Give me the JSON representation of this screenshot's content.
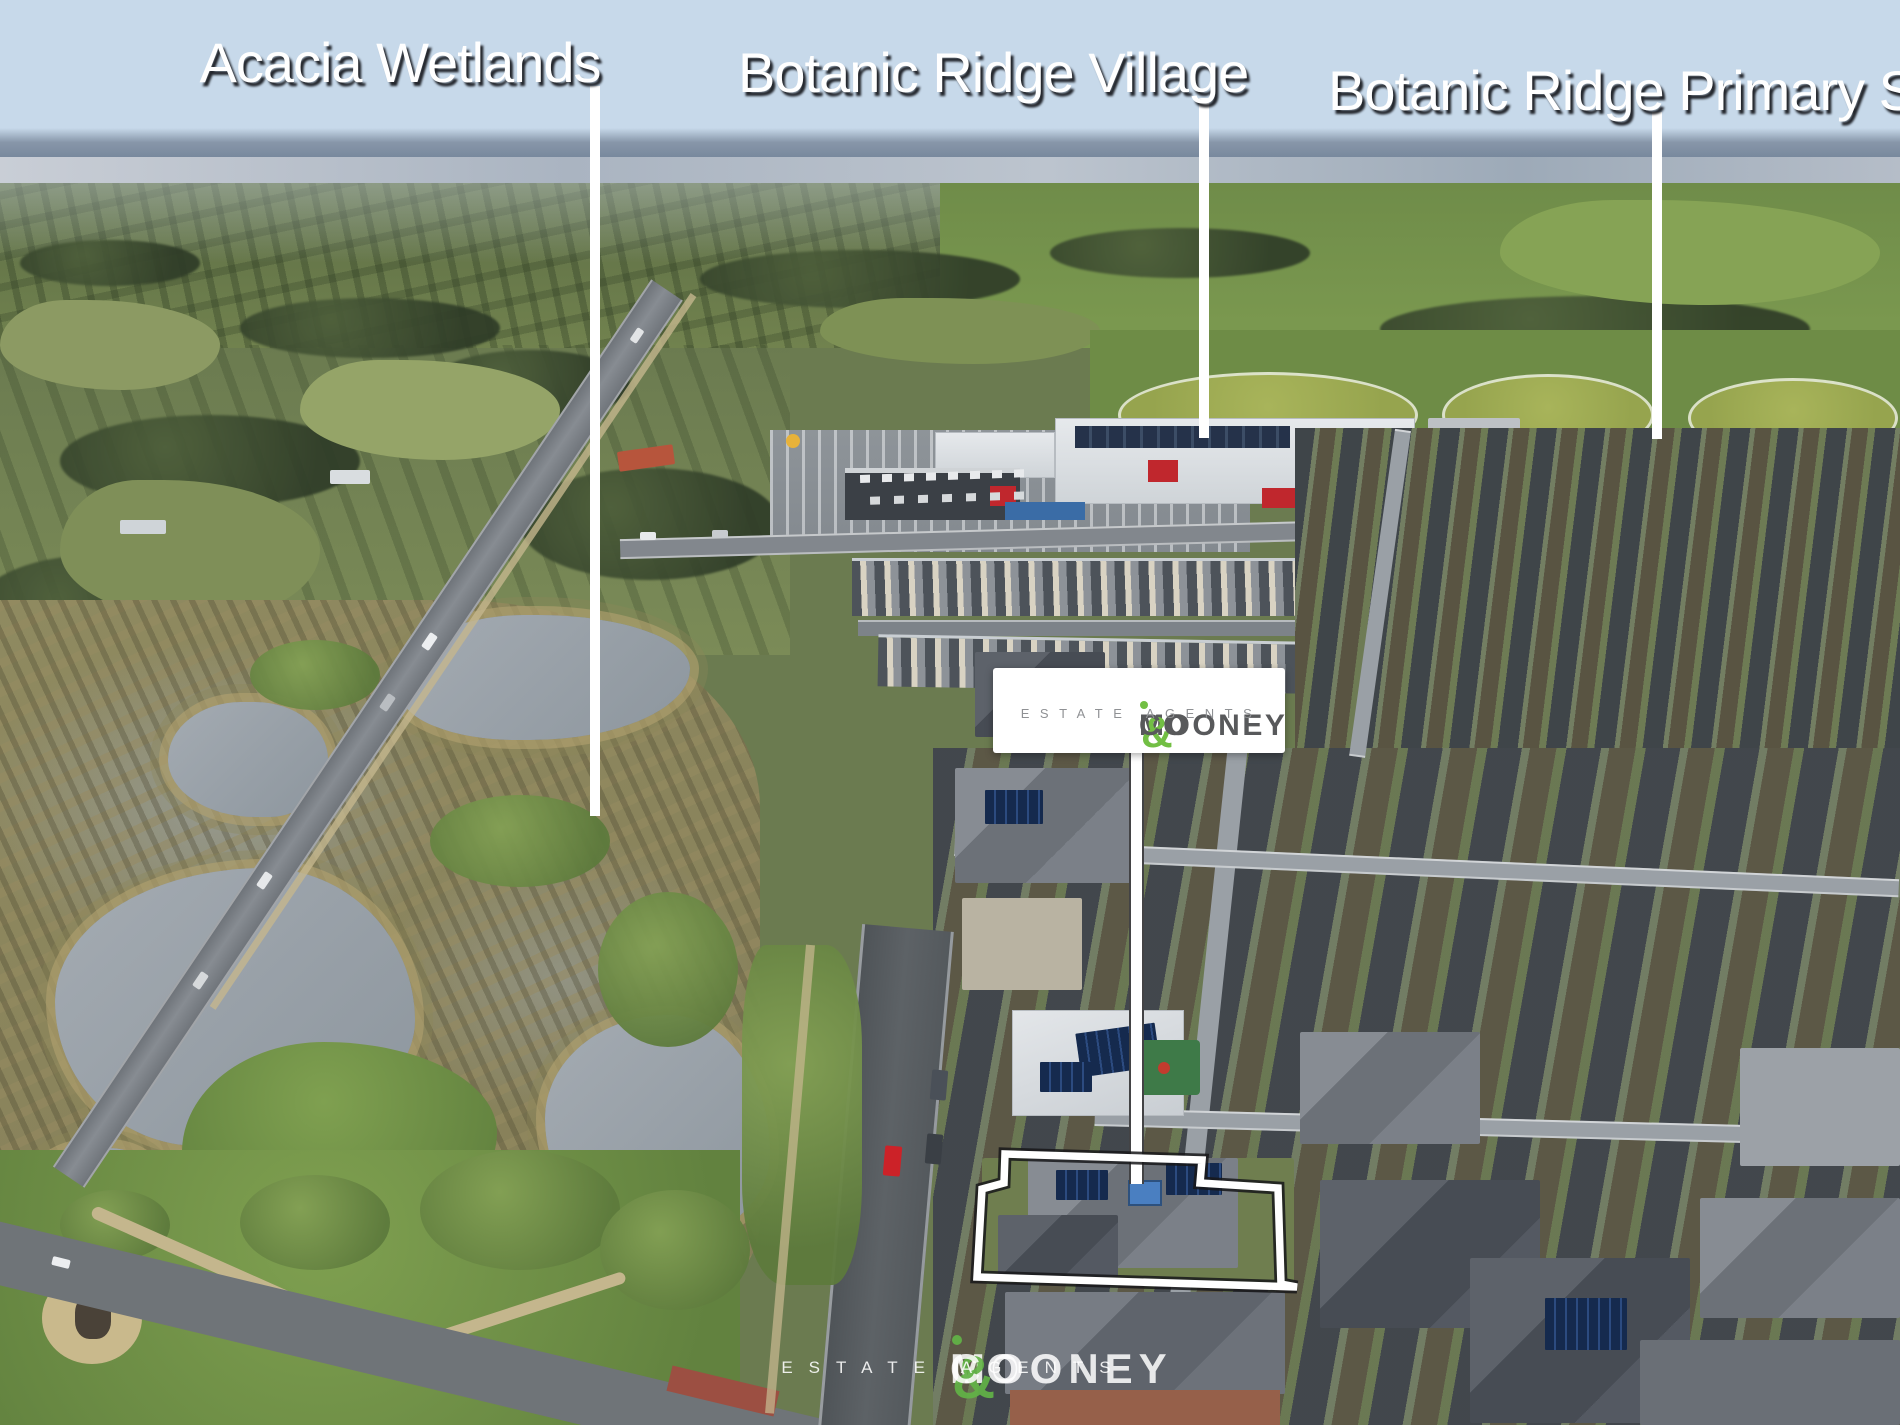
{
  "image_type": "aerial-property-marketing-photo",
  "labels": {
    "wetlands": "Acacia Wetlands",
    "village": "Botanic Ridge Village",
    "school": "Botanic Ridge Primary School"
  },
  "brand": {
    "name_part1": "MOONEY",
    "ampersand": "&",
    "name_part2": "CO",
    "tagline": "ESTATE AGENTS",
    "accent_green": "#72bf44",
    "text_gray": "#58595b"
  },
  "watermark": {
    "name_part1": "MOONEY",
    "ampersand": "&",
    "name_part2": "CO",
    "tagline": "ESTATE AGENTS"
  },
  "property_outline_color": "#ffffff",
  "leader_line_color": "#ffffff"
}
